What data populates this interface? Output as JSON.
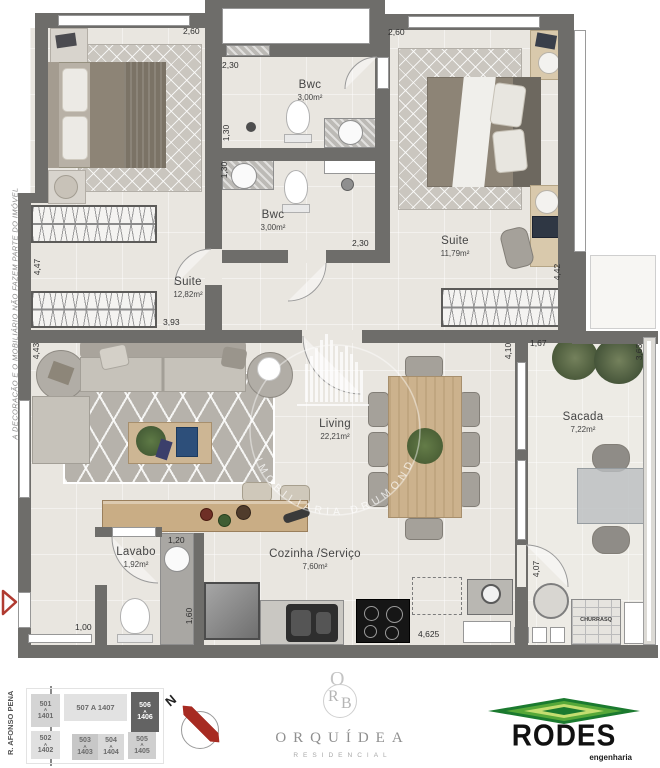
{
  "plan": {
    "disclaimer": "A DECORAÇÃO E O MOBILIÁRIO NÃO FAZEM PARTE DO IMÓVEL",
    "street": "R. AFONSO PENA",
    "watermark": "IMOBILIÁRIA DRUMOND",
    "rooms": {
      "suite_left": {
        "name": "Suite",
        "area": "12,82m²"
      },
      "suite_right": {
        "name": "Suite",
        "area": "11,79m²"
      },
      "bwc_top": {
        "name": "Bwc",
        "area": "3,00m²"
      },
      "bwc_bottom": {
        "name": "Bwc",
        "area": "3,00m²"
      },
      "living": {
        "name": "Living",
        "area": "22,21m²"
      },
      "sacada": {
        "name": "Sacada",
        "area": "7,22m²"
      },
      "lavabo": {
        "name": "Lavabo",
        "area": "1,92m²"
      },
      "cozinha": {
        "name": "Cozinha /Serviço",
        "area": "7,60m²"
      },
      "churrasqueira": {
        "name": "CHURRASQ"
      }
    },
    "dims": {
      "top_left_260": "2,60",
      "top_right_260": "2,60",
      "bwc_top_230": "2,30",
      "bwc_top_130": "1,30",
      "bwc_bottom_130": "1,30",
      "bwc_bottom_230": "2,30",
      "suite_left_447": "4,47",
      "suite_left_393": "3,93",
      "living_443": "4,43",
      "suite_right_442": "4,42",
      "living_410": "4,10",
      "sacada_167": "1,67",
      "sacada_363": "3,63",
      "sacada_407": "4,07",
      "lavabo_120": "1,20",
      "lavabo_160": "1,60",
      "hall_100": "1,00",
      "cozinha_4625": "4,625"
    }
  },
  "footer": {
    "north_label": "N",
    "keyplan": {
      "units": [
        {
          "top": "501",
          "sep": "A",
          "bottom": "1401"
        },
        {
          "inline": "507 A 1407"
        },
        {
          "top": "506",
          "sep": "A",
          "bottom": "1406",
          "highlight": true
        },
        {
          "top": "502",
          "sep": "A",
          "bottom": "1402"
        },
        {
          "top": "503",
          "sep": "A",
          "bottom": "1403"
        },
        {
          "top": "504",
          "sep": "A",
          "bottom": "1404"
        },
        {
          "top": "505",
          "sep": "A",
          "bottom": "1405"
        }
      ]
    },
    "orquidea": {
      "monogram_o": "O",
      "monogram_r": "R",
      "monogram_b": "B",
      "name": "ORQUÍDEA",
      "subtitle": "RESIDENCIAL"
    },
    "rodes": {
      "name": "RODES",
      "subtitle": "engenharia"
    }
  },
  "colors": {
    "wall": "#6e6d6a",
    "floor": "#e9e6e0",
    "accent_red": "#b03a30",
    "rodes_green": "#1b7a2f"
  }
}
